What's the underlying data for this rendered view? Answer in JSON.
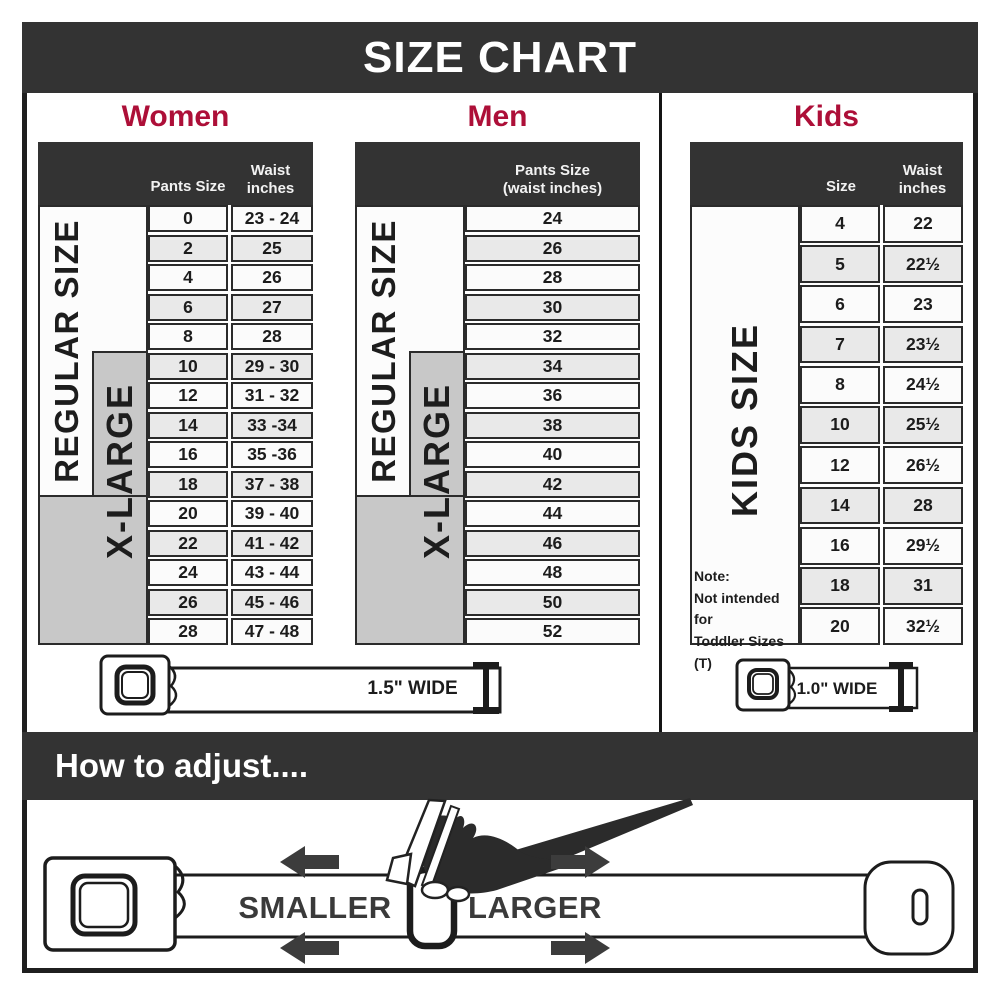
{
  "title": "SIZE CHART",
  "women": {
    "heading": "Women",
    "col_size": "Pants Size",
    "col_waist": "Waist inches",
    "regular_label": "REGULAR SIZE",
    "xlarge_label": "X-LARGE",
    "rows": [
      {
        "size": "0",
        "waist": "23 - 24"
      },
      {
        "size": "2",
        "waist": "25"
      },
      {
        "size": "4",
        "waist": "26"
      },
      {
        "size": "6",
        "waist": "27"
      },
      {
        "size": "8",
        "waist": "28"
      },
      {
        "size": "10",
        "waist": "29 - 30"
      },
      {
        "size": "12",
        "waist": "31 - 32"
      },
      {
        "size": "14",
        "waist": "33 -34"
      },
      {
        "size": "16",
        "waist": "35 -36"
      },
      {
        "size": "18",
        "waist": "37 - 38"
      },
      {
        "size": "20",
        "waist": "39 - 40"
      },
      {
        "size": "22",
        "waist": "41 - 42"
      },
      {
        "size": "24",
        "waist": "43 - 44"
      },
      {
        "size": "26",
        "waist": "45 - 46"
      },
      {
        "size": "28",
        "waist": "47 - 48"
      }
    ],
    "belt_width_label": "1.5\" WIDE"
  },
  "men": {
    "heading": "Men",
    "col_header_line1": "Pants Size",
    "col_header_line2": "(waist inches)",
    "regular_label": "REGULAR SIZE",
    "xlarge_label": "X-LARGE",
    "rows": [
      "24",
      "26",
      "28",
      "30",
      "32",
      "34",
      "36",
      "38",
      "40",
      "42",
      "44",
      "46",
      "48",
      "50",
      "52"
    ]
  },
  "kids": {
    "heading": "Kids",
    "col_size": "Size",
    "col_waist": "Waist inches",
    "side_label": "KIDS SIZE",
    "note": [
      "Note:",
      "Not intended for",
      "Toddler Sizes (T)"
    ],
    "rows": [
      {
        "size": "4",
        "waist": "22"
      },
      {
        "size": "5",
        "waist": "22½"
      },
      {
        "size": "6",
        "waist": "23"
      },
      {
        "size": "7",
        "waist": "23½"
      },
      {
        "size": "8",
        "waist": "24½"
      },
      {
        "size": "10",
        "waist": "25½"
      },
      {
        "size": "12",
        "waist": "26½"
      },
      {
        "size": "14",
        "waist": "28"
      },
      {
        "size": "16",
        "waist": "29½"
      },
      {
        "size": "18",
        "waist": "31"
      },
      {
        "size": "20",
        "waist": "32½"
      }
    ],
    "belt_width_label": "1.0\" WIDE"
  },
  "adjust": {
    "heading": "How to adjust....",
    "smaller_label": "SMALLER",
    "larger_label": "LARGER"
  },
  "colors": {
    "dark": "#333333",
    "accent_red": "#AD0F38",
    "gray_fill": "#C8C8C8",
    "row_light": "#FBFBFB",
    "row_alt": "#E9E9E9",
    "line": "#2B2B2B"
  },
  "chart_data": [
    {
      "type": "table",
      "title": "Women",
      "columns": [
        "Pants Size",
        "Waist inches"
      ],
      "size_groups": {
        "REGULAR SIZE": [
          "0",
          "2",
          "4",
          "6",
          "8",
          "10",
          "12",
          "14",
          "16",
          "18"
        ],
        "X-LARGE": [
          "10",
          "12",
          "14",
          "16",
          "18",
          "20",
          "22",
          "24",
          "26",
          "28"
        ]
      },
      "rows": [
        [
          "0",
          "23 - 24"
        ],
        [
          "2",
          "25"
        ],
        [
          "4",
          "26"
        ],
        [
          "6",
          "27"
        ],
        [
          "8",
          "28"
        ],
        [
          "10",
          "29 - 30"
        ],
        [
          "12",
          "31 - 32"
        ],
        [
          "14",
          "33 -34"
        ],
        [
          "16",
          "35 -36"
        ],
        [
          "18",
          "37 - 38"
        ],
        [
          "20",
          "39 - 40"
        ],
        [
          "22",
          "41 - 42"
        ],
        [
          "24",
          "43 - 44"
        ],
        [
          "26",
          "45 - 46"
        ],
        [
          "28",
          "47 - 48"
        ]
      ],
      "belt_width": "1.5\" WIDE"
    },
    {
      "type": "table",
      "title": "Men",
      "columns": [
        "Pants Size (waist inches)"
      ],
      "size_groups": {
        "REGULAR SIZE": [
          "24",
          "26",
          "28",
          "30",
          "32",
          "34",
          "36",
          "38",
          "40"
        ],
        "X-LARGE": [
          "34",
          "36",
          "38",
          "40",
          "42",
          "44",
          "46",
          "48",
          "50",
          "52"
        ]
      },
      "rows": [
        [
          "24"
        ],
        [
          "26"
        ],
        [
          "28"
        ],
        [
          "30"
        ],
        [
          "32"
        ],
        [
          "34"
        ],
        [
          "36"
        ],
        [
          "38"
        ],
        [
          "40"
        ],
        [
          "42"
        ],
        [
          "44"
        ],
        [
          "46"
        ],
        [
          "48"
        ],
        [
          "50"
        ],
        [
          "52"
        ]
      ],
      "belt_width": "1.5\" WIDE"
    },
    {
      "type": "table",
      "title": "Kids",
      "columns": [
        "Size",
        "Waist inches"
      ],
      "size_groups": {
        "KIDS SIZE": [
          "4",
          "5",
          "6",
          "7",
          "8",
          "10",
          "12",
          "14",
          "16",
          "18",
          "20"
        ]
      },
      "rows": [
        [
          "4",
          "22"
        ],
        [
          "5",
          "22½"
        ],
        [
          "6",
          "23"
        ],
        [
          "7",
          "23½"
        ],
        [
          "8",
          "24½"
        ],
        [
          "10",
          "25½"
        ],
        [
          "12",
          "26½"
        ],
        [
          "14",
          "28"
        ],
        [
          "16",
          "29½"
        ],
        [
          "18",
          "31"
        ],
        [
          "20",
          "32½"
        ]
      ],
      "note": "Note: Not intended for Toddler Sizes (T)",
      "belt_width": "1.0\" WIDE"
    }
  ]
}
